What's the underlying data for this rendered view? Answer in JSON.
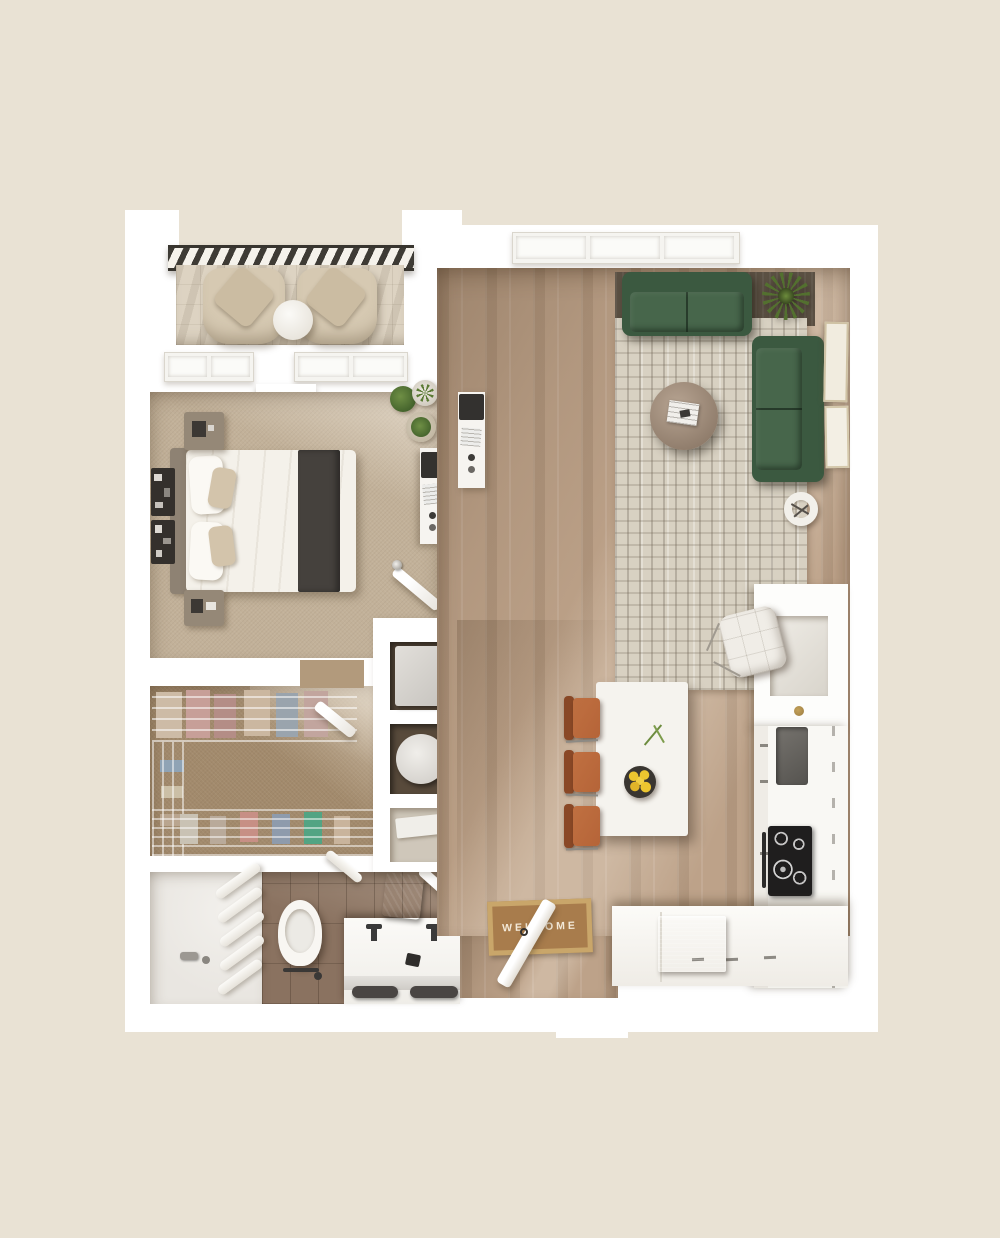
{
  "scene": {
    "type": "3d-top-down-floor-plan"
  },
  "mat": {
    "text": "WELCOME"
  },
  "palette": {
    "background": "#e9e2d4",
    "wall": "#ffffff",
    "wood": "#bda289",
    "bedroom_carpet": "#c2b199",
    "closet_carpet": "#a28a6c",
    "bath_tile": "#8a7260",
    "shower": "#e9e6e1",
    "rug": "#d8d1c2",
    "rug_dark": "#5b5043",
    "sofa": "#3b5940",
    "sofa_light": "#47664b",
    "stool": "#b56438",
    "stool_dark": "#8a4826",
    "island": "#f5f3ee",
    "mat_brown": "#a87c4c",
    "mat_border": "#c9a66a",
    "mat_text": "#f3e9d8",
    "plant": "#53702f",
    "plant_dark": "#37461f",
    "cooktop": "#1f1e1e",
    "stainless": "#b7babc",
    "table_wood": "#a9937f",
    "linen": "#f4f1ea",
    "runner": "#45413d",
    "headboard": "#8e8273",
    "balcony_chair": "#d6c9b2",
    "balcony_floor": "#ddd3c2",
    "railing": "#3e3b35",
    "lemon": "#ecc52f",
    "towel": "#494543",
    "vanity_green": "#2e4234"
  }
}
